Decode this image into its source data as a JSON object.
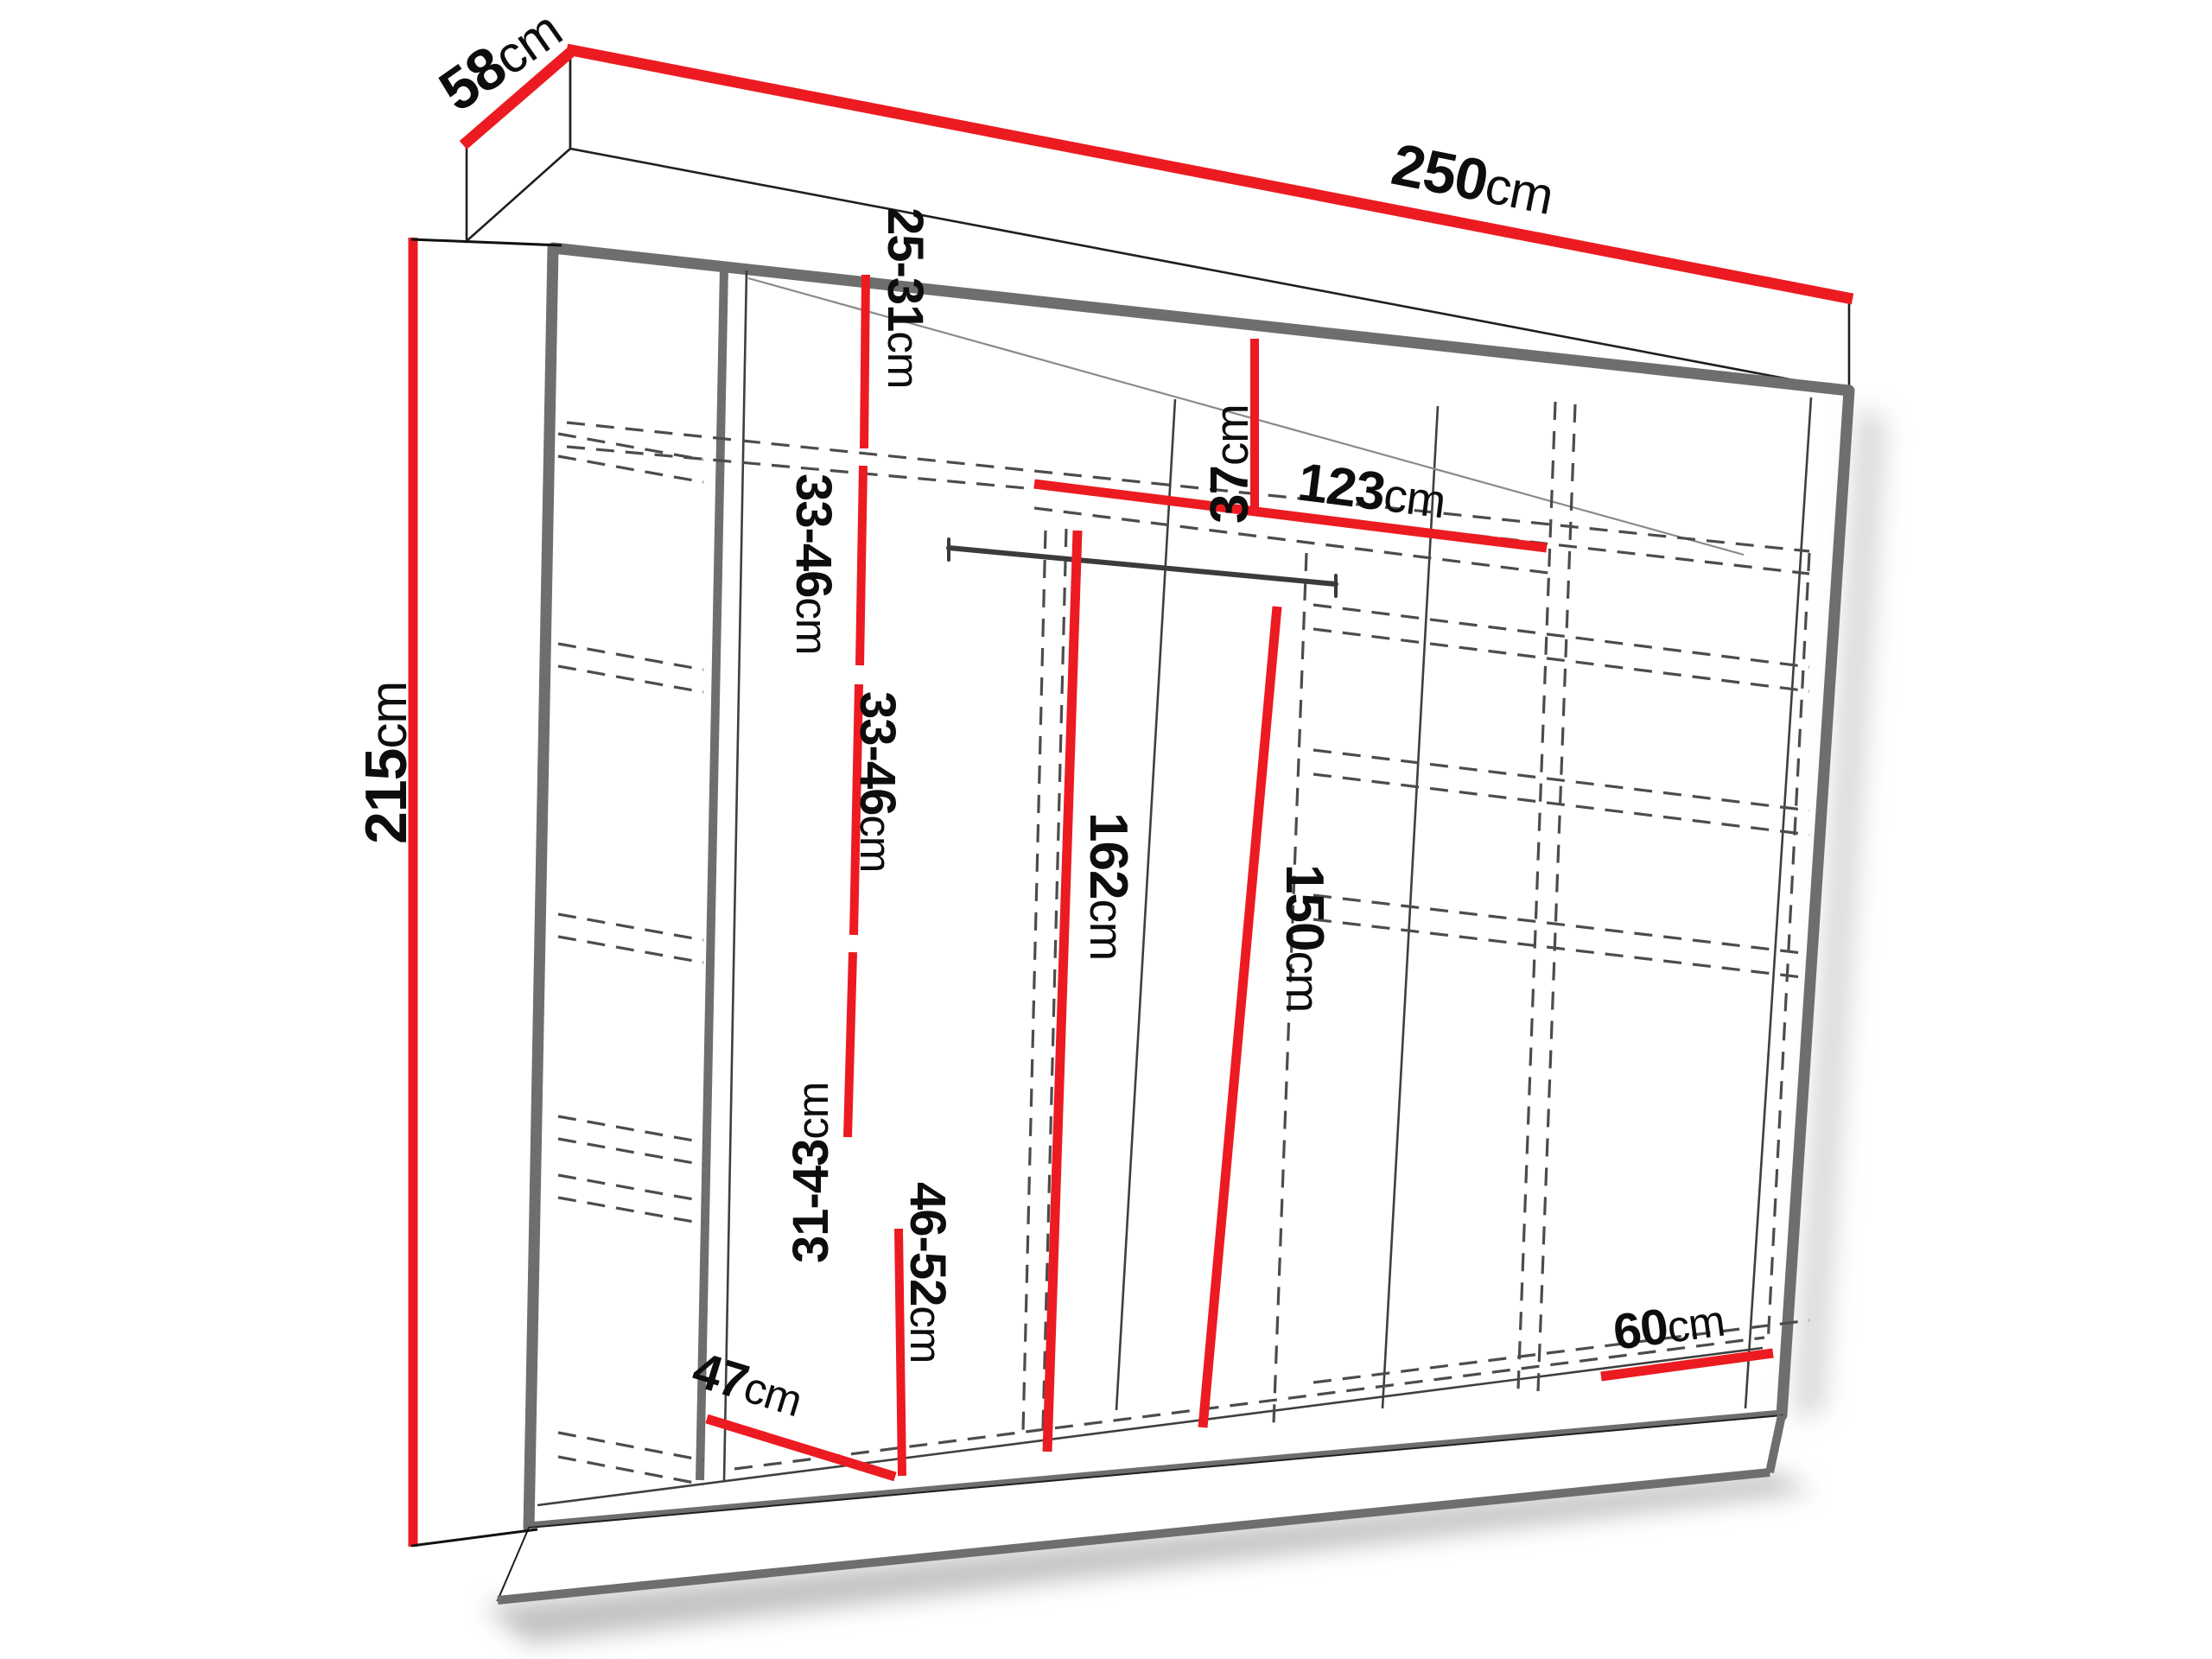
{
  "diagram": {
    "title": "wardrobe-dimension-diagram",
    "accent_red": "#ec1b21",
    "outline_gray": "#6e6e6e",
    "dimensions": {
      "width": {
        "value": "250",
        "unit": "cm"
      },
      "depth": {
        "value": "58",
        "unit": "cm"
      },
      "height": {
        "value": "215",
        "unit": "cm"
      },
      "top_shelf": {
        "value": "37",
        "unit": "cm"
      },
      "shelf_width": {
        "value": "123",
        "unit": "cm"
      },
      "hang_left": {
        "value": "162",
        "unit": "cm"
      },
      "hang_right": {
        "value": "150",
        "unit": "cm"
      },
      "depth_left": {
        "value": "47",
        "unit": "cm"
      },
      "depth_right": {
        "value": "60",
        "unit": "cm"
      },
      "left_column_gaps": [
        {
          "value": "25-31",
          "unit": "cm"
        },
        {
          "value": "33-46",
          "unit": "cm"
        },
        {
          "value": "33-46",
          "unit": "cm"
        },
        {
          "value": "31-43",
          "unit": "cm"
        },
        {
          "value": "46-52",
          "unit": "cm"
        }
      ]
    }
  }
}
